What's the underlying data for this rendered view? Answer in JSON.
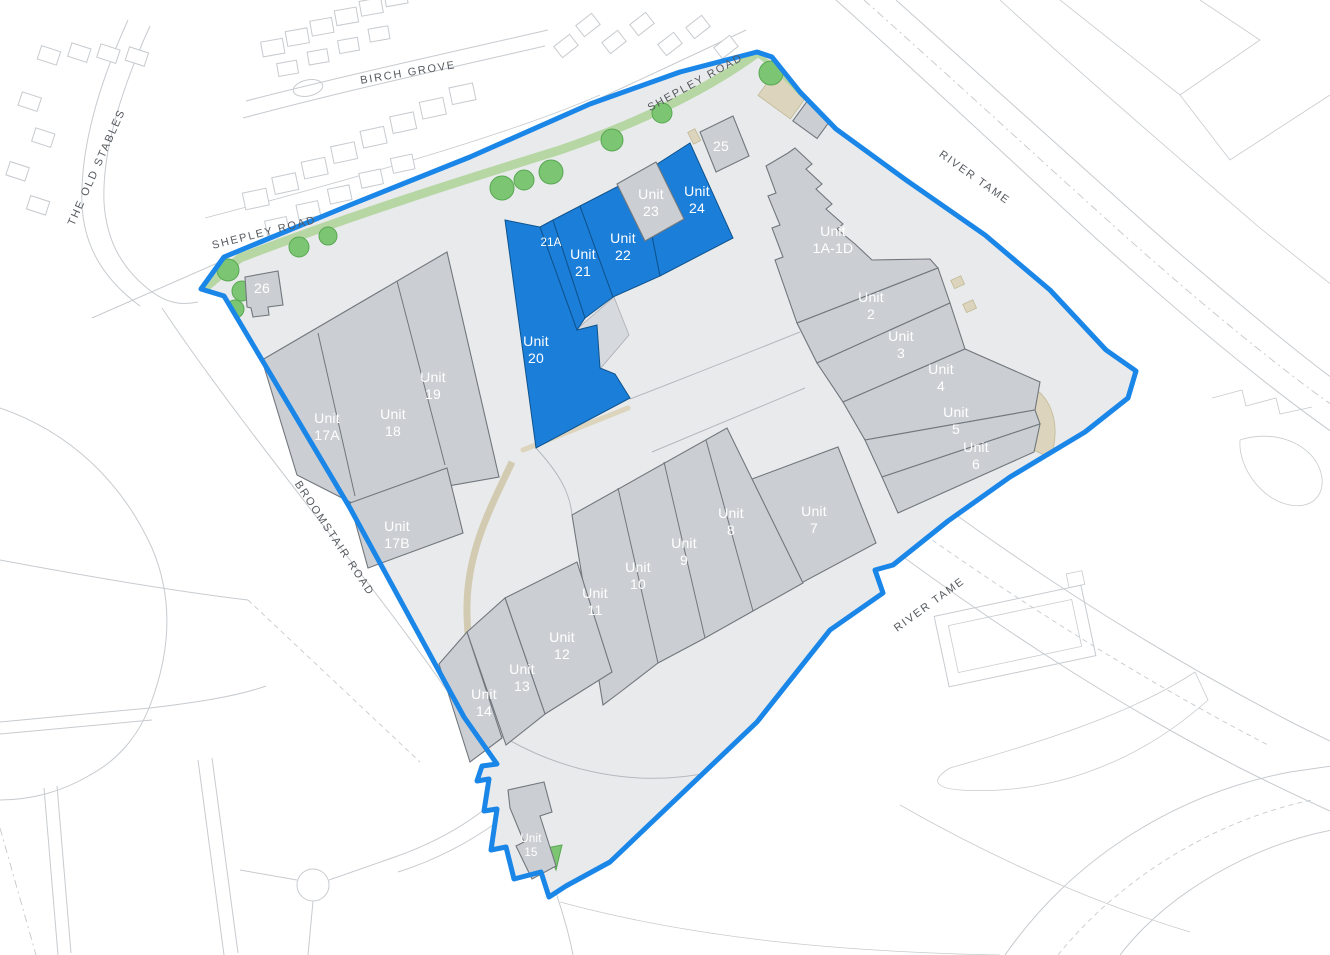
{
  "site_plan": {
    "roads": {
      "birch_grove": "BIRCH GROVE",
      "the_old_stables": "THE OLD STABLES",
      "shepley_road_top": "SHEPLEY ROAD",
      "shepley_road_west": "SHEPLEY ROAD",
      "river_tame_north": "RIVER TAME",
      "river_tame_south": "RIVER TAME",
      "broomstair_road": "BROOMSTAIR ROAD"
    },
    "units": {
      "u1a1d": {
        "line1": "Unit",
        "line2": "1A-1D",
        "highlighted": false
      },
      "u2": {
        "line1": "Unit",
        "line2": "2",
        "highlighted": false
      },
      "u3": {
        "line1": "Unit",
        "line2": "3",
        "highlighted": false
      },
      "u4": {
        "line1": "Unit",
        "line2": "4",
        "highlighted": false
      },
      "u5": {
        "line1": "Unit",
        "line2": "5",
        "highlighted": false
      },
      "u6": {
        "line1": "Unit",
        "line2": "6",
        "highlighted": false
      },
      "u7": {
        "line1": "Unit",
        "line2": "7",
        "highlighted": false
      },
      "u8": {
        "line1": "Unit",
        "line2": "8",
        "highlighted": false
      },
      "u9": {
        "line1": "Unit",
        "line2": "9",
        "highlighted": false
      },
      "u10": {
        "line1": "Unit",
        "line2": "10",
        "highlighted": false
      },
      "u11": {
        "line1": "Unit",
        "line2": "11",
        "highlighted": false
      },
      "u12": {
        "line1": "Unit",
        "line2": "12",
        "highlighted": false
      },
      "u13": {
        "line1": "Unit",
        "line2": "13",
        "highlighted": false
      },
      "u14": {
        "line1": "Unit",
        "line2": "14",
        "highlighted": false
      },
      "u15": {
        "line1": "Unit",
        "line2": "15",
        "highlighted": false
      },
      "u17a": {
        "line1": "Unit",
        "line2": "17A",
        "highlighted": false
      },
      "u17b": {
        "line1": "Unit",
        "line2": "17B",
        "highlighted": false
      },
      "u18": {
        "line1": "Unit",
        "line2": "18",
        "highlighted": false
      },
      "u19": {
        "line1": "Unit",
        "line2": "19",
        "highlighted": false
      },
      "u20": {
        "line1": "Unit",
        "line2": "20",
        "highlighted": true
      },
      "u21a": {
        "line1": "",
        "line2": "21A",
        "highlighted": true
      },
      "u21": {
        "line1": "Unit",
        "line2": "21",
        "highlighted": true
      },
      "u22": {
        "line1": "Unit",
        "line2": "22",
        "highlighted": true
      },
      "u23": {
        "line1": "Unit",
        "line2": "23",
        "highlighted": false
      },
      "u24": {
        "line1": "Unit",
        "line2": "24",
        "highlighted": true
      },
      "u25": {
        "line1": "",
        "line2": "25",
        "highlighted": false
      },
      "u26": {
        "line1": "",
        "line2": "26",
        "highlighted": false
      }
    },
    "colors": {
      "highlight": "#1b7ed9",
      "building": "#cbcfd3",
      "boundary": "#1a86e8",
      "site": "#e9eaec",
      "green": "#7cc573",
      "hedge": "#b6d7a3",
      "beige": "#dcd4bc"
    }
  }
}
